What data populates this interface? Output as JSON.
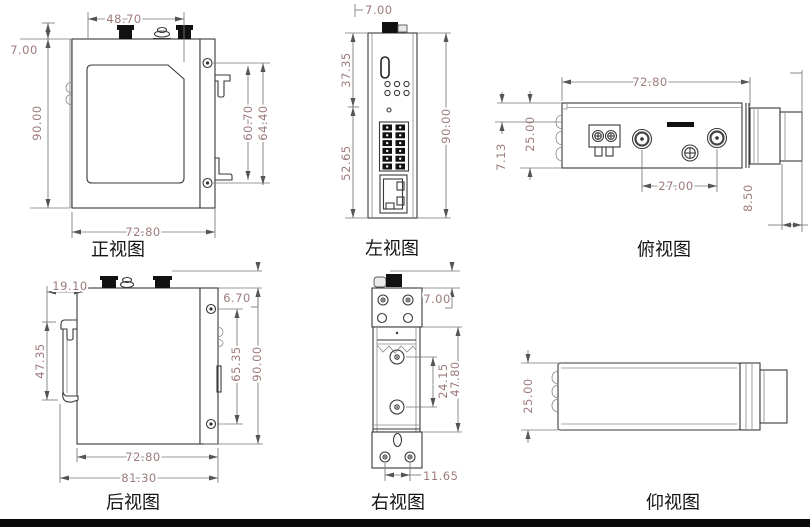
{
  "page": {
    "background": "#ffffff",
    "footer_bar_color": "#0b0b0b"
  },
  "colors": {
    "dimension_text": "#9d7b7b",
    "outline": "#3a3a3a",
    "dimension_line": "#777777",
    "view_label": "#151515"
  },
  "views": {
    "front": {
      "label": "正视图",
      "dims": {
        "antenna_span": "48.70",
        "top_offset": "7.00",
        "height": "90.00",
        "din_clip_inner": "60.70",
        "din_clip_outer": "64.40",
        "width": "72.80"
      }
    },
    "left": {
      "label": "左视图",
      "dims": {
        "top_offset": "7.00",
        "upper_section": "37.35",
        "lower_section": "52.65",
        "height": "90.00"
      }
    },
    "top": {
      "label": "俯视图",
      "dims": {
        "width": "72.80",
        "depth": "25.00",
        "edge_offset": "7.13",
        "antenna_spacing": "27.00",
        "clip_depth": "8.50"
      }
    },
    "rear": {
      "label": "后视图",
      "dims": {
        "edge_offset": "19.10",
        "clip_height": "47.35",
        "antenna_height": "6.70",
        "screw_spacing": "65.35",
        "height": "90.00",
        "width": "72.80",
        "overall_width": "81.30"
      }
    },
    "right": {
      "label": "右视图",
      "dims": {
        "antenna_height": "7.00",
        "screw_spacing": "24.15",
        "rail_height": "47.80",
        "hole_spacing": "11.65"
      }
    },
    "bottom": {
      "label": "仰视图",
      "dims": {
        "depth": "25.00"
      }
    }
  }
}
